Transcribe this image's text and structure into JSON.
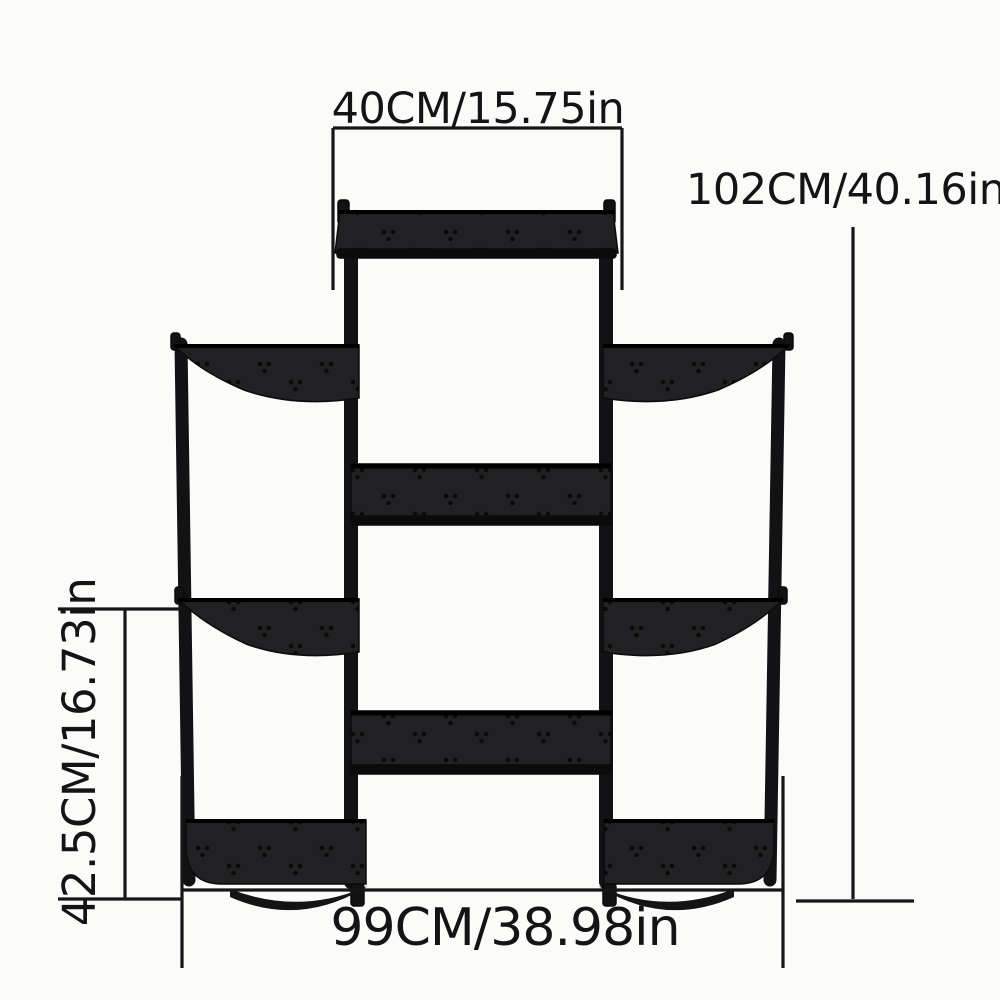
{
  "page": {
    "title": "Plant stand size chart"
  },
  "diagram": {
    "type": "product-dimension-diagram",
    "product": "multi-tier-plant-stand-shelf",
    "colors": {
      "background": "#fbfbf9",
      "ink": "#161616",
      "shelf_fill": "#212124",
      "shelf_edge": "#0b0b0c"
    },
    "labels": {
      "top_width": "40CM/15.75in",
      "total_height": "102CM/40.16in",
      "tier_height": "42.5CM/16.73in",
      "total_width": "99CM/38.98in"
    }
  }
}
